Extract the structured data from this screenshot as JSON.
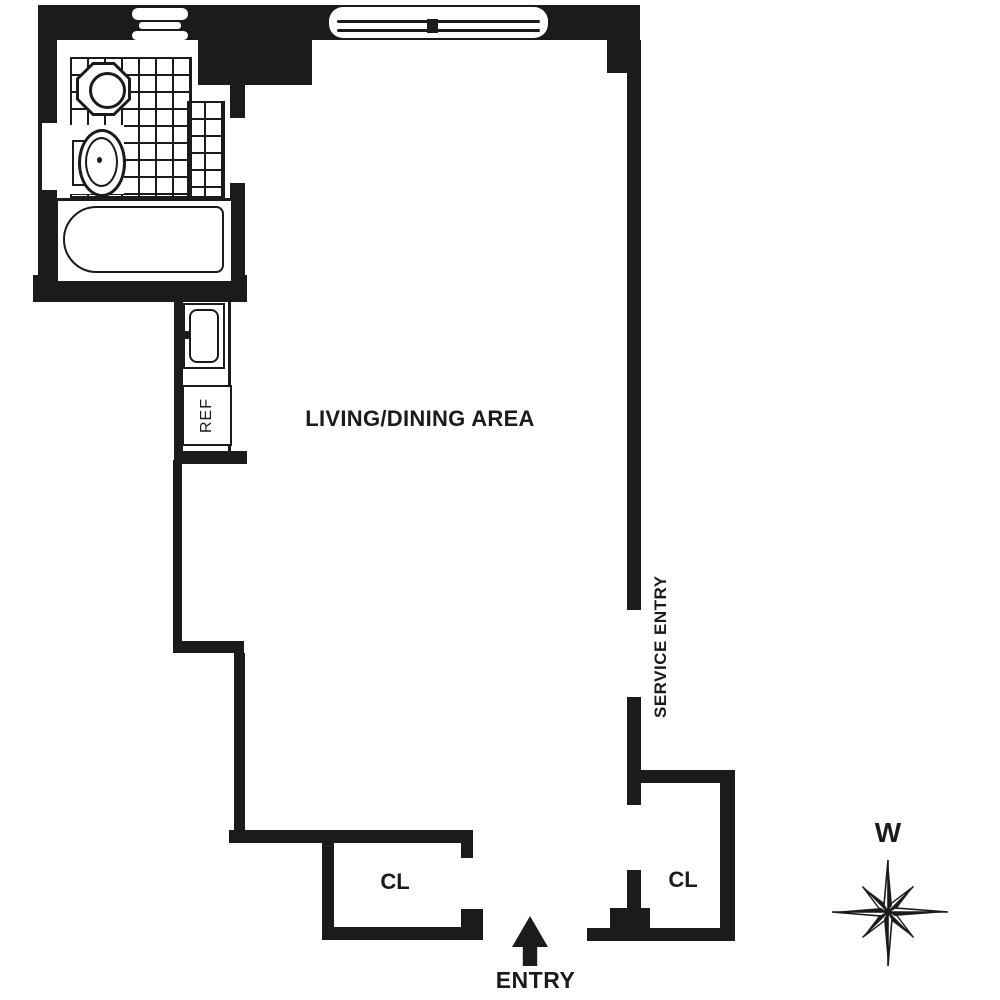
{
  "floor_plan": {
    "rooms": {
      "living_dining": {
        "label": "LIVING/DINING AREA"
      },
      "bathroom": {
        "fixtures": [
          "tub",
          "toilet",
          "sink"
        ]
      },
      "kitchen": {
        "refrigerator_label": "REF",
        "fixtures": [
          "sink",
          "refrigerator"
        ]
      },
      "closet_left": {
        "label": "CL"
      },
      "closet_right": {
        "label": "CL"
      }
    },
    "entries": {
      "main": {
        "label": "ENTRY"
      },
      "service": {
        "label": "SERVICE ENTRY"
      }
    },
    "compass": {
      "direction_label": "W"
    }
  },
  "colors": {
    "wall": "#1b1b1b",
    "background": "#ffffff"
  }
}
